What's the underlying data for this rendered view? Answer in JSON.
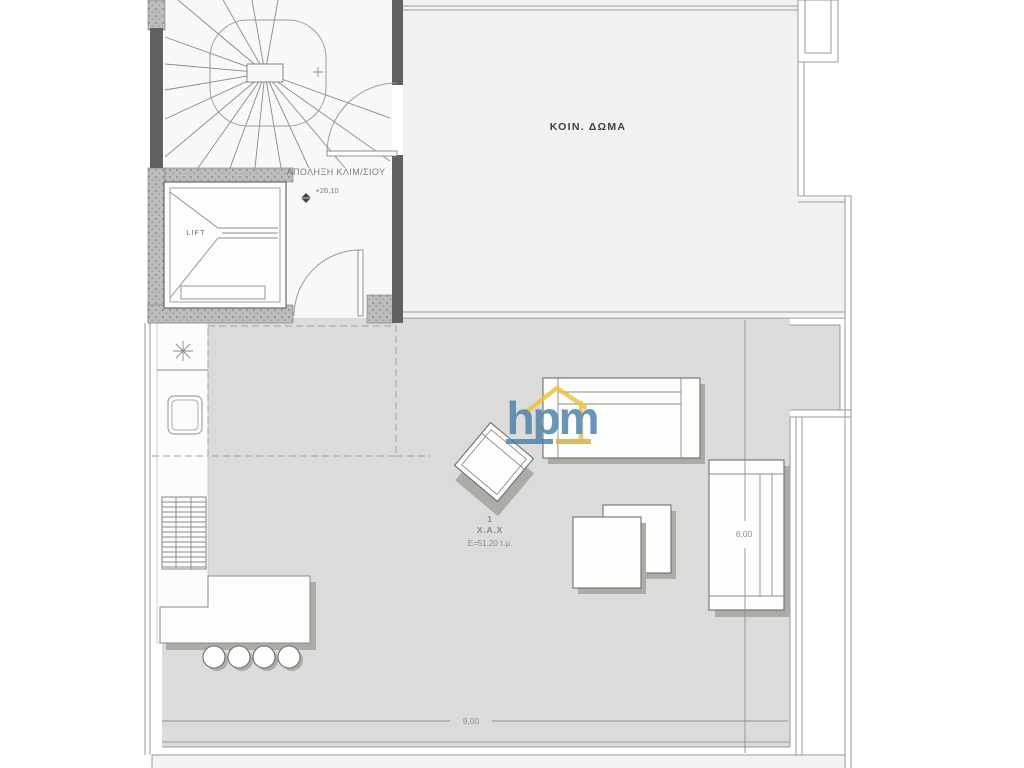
{
  "labels": {
    "stair_area": "ΑΠΟΛΗΞΗ ΚΛΙΜ/ΣΙΟΥ",
    "elevation": "+26,10",
    "common_roof": "ΚΟΙΝ. ΔΩΜΑ",
    "lift": "LIFT"
  },
  "room": {
    "number": "1",
    "type": "Χ.Α.Χ",
    "area": "Ε=51.20 τ.μ."
  },
  "dimensions": {
    "vertical": "6,00",
    "horizontal": "9,00"
  },
  "logo": {
    "text": "hpm"
  },
  "colors": {
    "terrace": "#dbdbd9",
    "roof_area": "#f1f1f0",
    "stair_area": "#f8f8f7",
    "corridor": "#fcfcfb",
    "wall_fill": "#bcbcba",
    "wall_dark": "#606060",
    "line": "#9a9a9a",
    "logo_blue": "#4b7fa7",
    "logo_yellow": "#eec23e"
  }
}
